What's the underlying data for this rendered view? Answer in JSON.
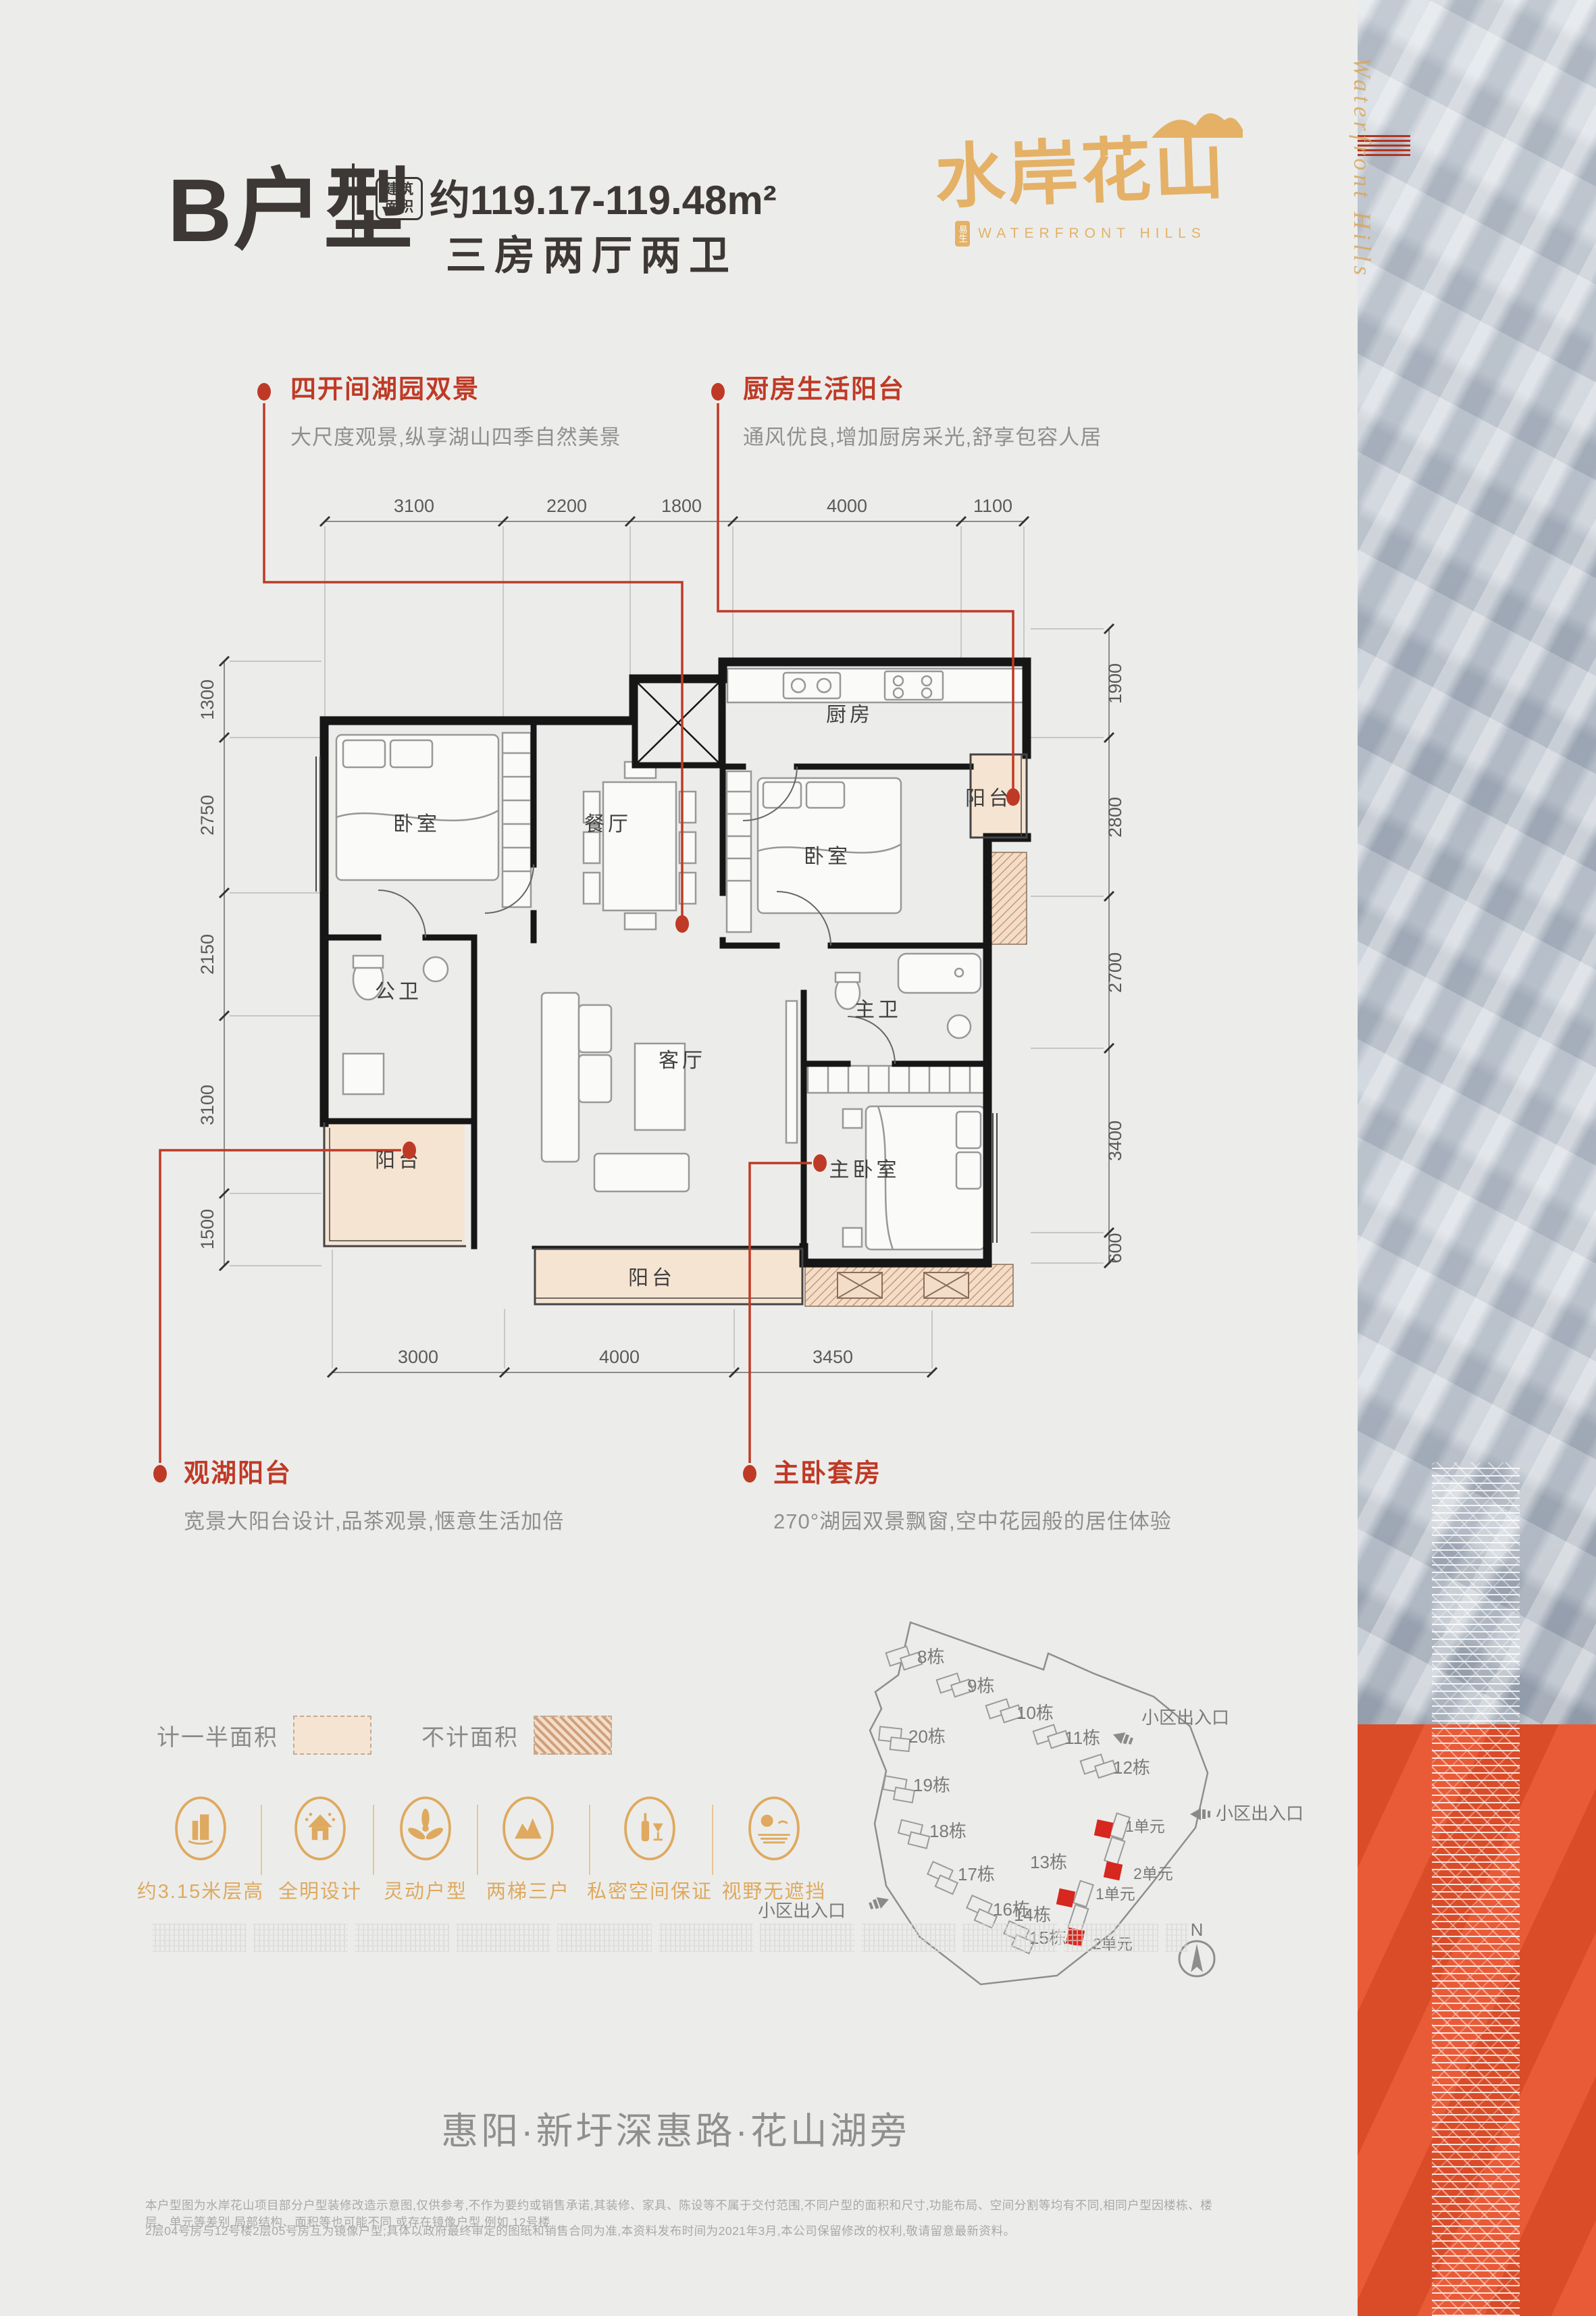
{
  "header": {
    "unit_label": "B户型",
    "area_badge_1": "建筑",
    "area_badge_2": "面积",
    "area_value": "约119.17-119.48m²",
    "layout": "三房两厅两卫",
    "logo_cn": "水岸花山",
    "logo_en": "WATERFRONT HILLS",
    "logo_seal": "易生"
  },
  "callouts": [
    {
      "title": "四开间湖园双景",
      "desc": "大尺度观景,纵享湖山四季自然美景"
    },
    {
      "title": "厨房生活阳台",
      "desc": "通风优良,增加厨房采光,舒享包容人居"
    },
    {
      "title": "观湖阳台",
      "desc": "宽景大阳台设计,品茶观景,惬意生活加倍"
    },
    {
      "title": "主卧套房",
      "desc": "270°湖园双景飘窗,空中花园般的居住体验"
    }
  ],
  "floorplan": {
    "rooms": {
      "bedroom_left": "卧室",
      "dining": "餐厅",
      "kitchen": "厨房",
      "kitchen_balcony": "阳台",
      "bedroom_right": "卧室",
      "bath_public": "公卫",
      "bath_master": "主卫",
      "living": "客厅",
      "master": "主卧室",
      "balcony_left": "阳台",
      "balcony_bottom": "阳台"
    },
    "dims": {
      "top": [
        "3100",
        "2200",
        "1800",
        "4000",
        "1100"
      ],
      "left": [
        "1300",
        "2750",
        "2150",
        "3100",
        "1500"
      ],
      "right": [
        "1900",
        "2800",
        "2700",
        "3400",
        "600"
      ],
      "bottom": [
        "3000",
        "4000",
        "3450"
      ]
    }
  },
  "legend": {
    "half_label": "计一半面积",
    "none_label": "不计面积"
  },
  "features": [
    {
      "icon": "building-icon",
      "label": "约3.15米层高"
    },
    {
      "icon": "house-icon",
      "label": "全明设计"
    },
    {
      "icon": "fan-icon",
      "label": "灵动户型"
    },
    {
      "icon": "mountain-icon",
      "label": "两梯三户"
    },
    {
      "icon": "wine-icon",
      "label": "私密空间保证"
    },
    {
      "icon": "view-icon",
      "label": "视野无遮挡"
    }
  ],
  "siteplan": {
    "buildings": [
      "8栋",
      "9栋",
      "10栋",
      "11栋",
      "12栋",
      "20栋",
      "19栋",
      "18栋",
      "17栋",
      "16栋",
      "15栋",
      "13栋",
      "14栋"
    ],
    "units": [
      "1单元",
      "2单元",
      "1单元",
      "2单元"
    ],
    "entrances": [
      "小区出入口",
      "小区出入口",
      "小区出入口"
    ],
    "compass": "N"
  },
  "strip": {
    "script": "Waterfront Hills"
  },
  "footer": {
    "address": "惠阳·新圩深惠路·花山湖旁",
    "disclaimer_1": "本户型图为水岸花山项目部分户型装修改造示意图,仅供参考,不作为要约或销售承诺,其装修、家具、陈设等不属于交付范围,不同户型的面积和尺寸,功能布局、空间分割等均有不同,相同户型因楼栋、楼层、单元等差别,局部结构、面积等也可能不同,或存在镜像户型,例如,12号楼",
    "disclaimer_2": "2层04号房与12号楼2层05号房互为镜像户型;具体以政府最终审定的图纸和销售合同为准,本资料发布时间为2021年3月,本公司保留修改的权利,敬请留意最新资料。"
  },
  "colors": {
    "accent_red": "#bf3a26",
    "gold": "#dfa95f",
    "logo_gold": "#e4b167",
    "orange": "#e8512b",
    "beige": "#f6e4d2",
    "hatch": "#c79a78",
    "text_dark": "#3d3835",
    "text_gray": "#8f8f8f"
  }
}
